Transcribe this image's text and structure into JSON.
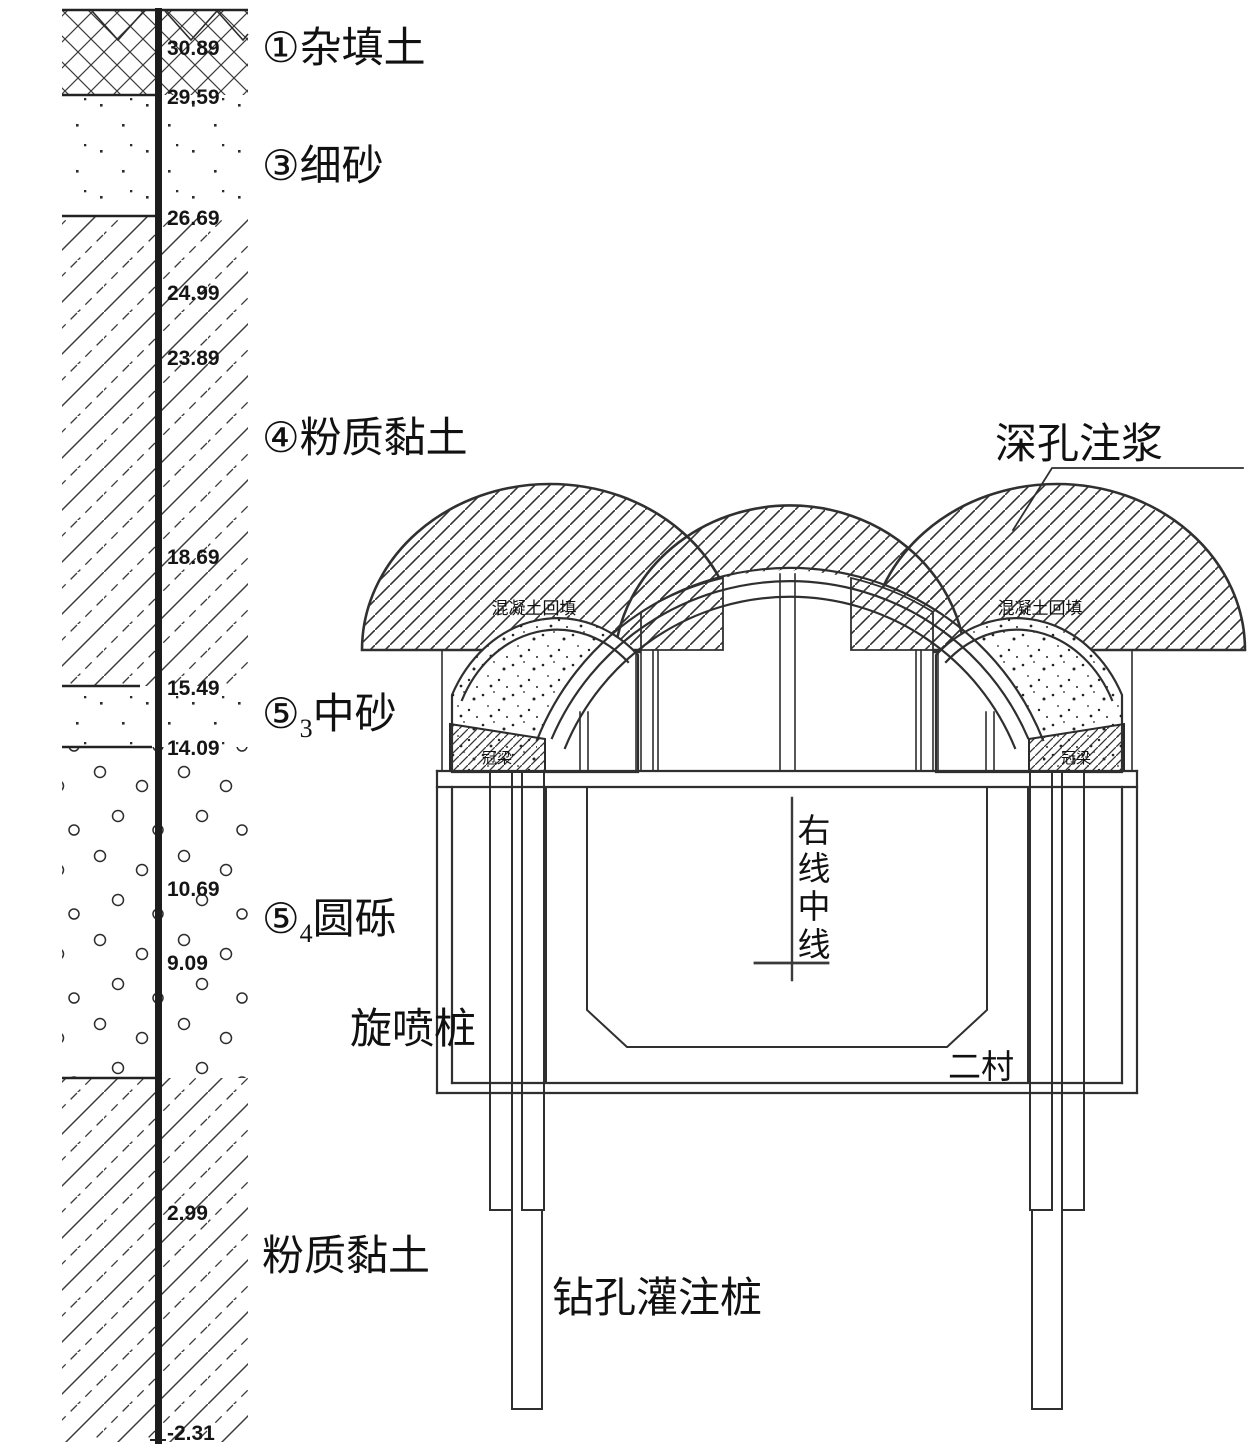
{
  "colors": {
    "ink": "#2f2f2f",
    "text": "#111111",
    "background": "#ffffff"
  },
  "borehole": {
    "elevations": [
      "30.89",
      "29.59",
      "26.69",
      "24.99",
      "23.89",
      "18.69",
      "15.49",
      "14.09",
      "10.69",
      "9.09",
      "2.99",
      "-2.31"
    ]
  },
  "strata_labels": [
    {
      "prefix": "①",
      "sub": "",
      "name": "杂填土"
    },
    {
      "prefix": "③",
      "sub": "",
      "name": "细砂"
    },
    {
      "prefix": "④",
      "sub": "",
      "name": "粉质黏土"
    },
    {
      "prefix": "⑤",
      "sub": "3",
      "name": "中砂"
    },
    {
      "prefix": "⑤",
      "sub": "4",
      "name": "圆砾"
    },
    {
      "prefix": "",
      "sub": "",
      "name": "粉质黏土"
    }
  ],
  "tunnel_labels": {
    "deep_hole_grouting": "深孔注浆",
    "jet_grouting_pile": "旋喷桩",
    "secondary_lining": "二村",
    "bored_pile": "钻孔灌注桩",
    "crown_beam": "冠梁",
    "concrete_backfill": "混凝土回填",
    "centerline_chars": [
      "右",
      "线",
      "中",
      "线"
    ]
  }
}
